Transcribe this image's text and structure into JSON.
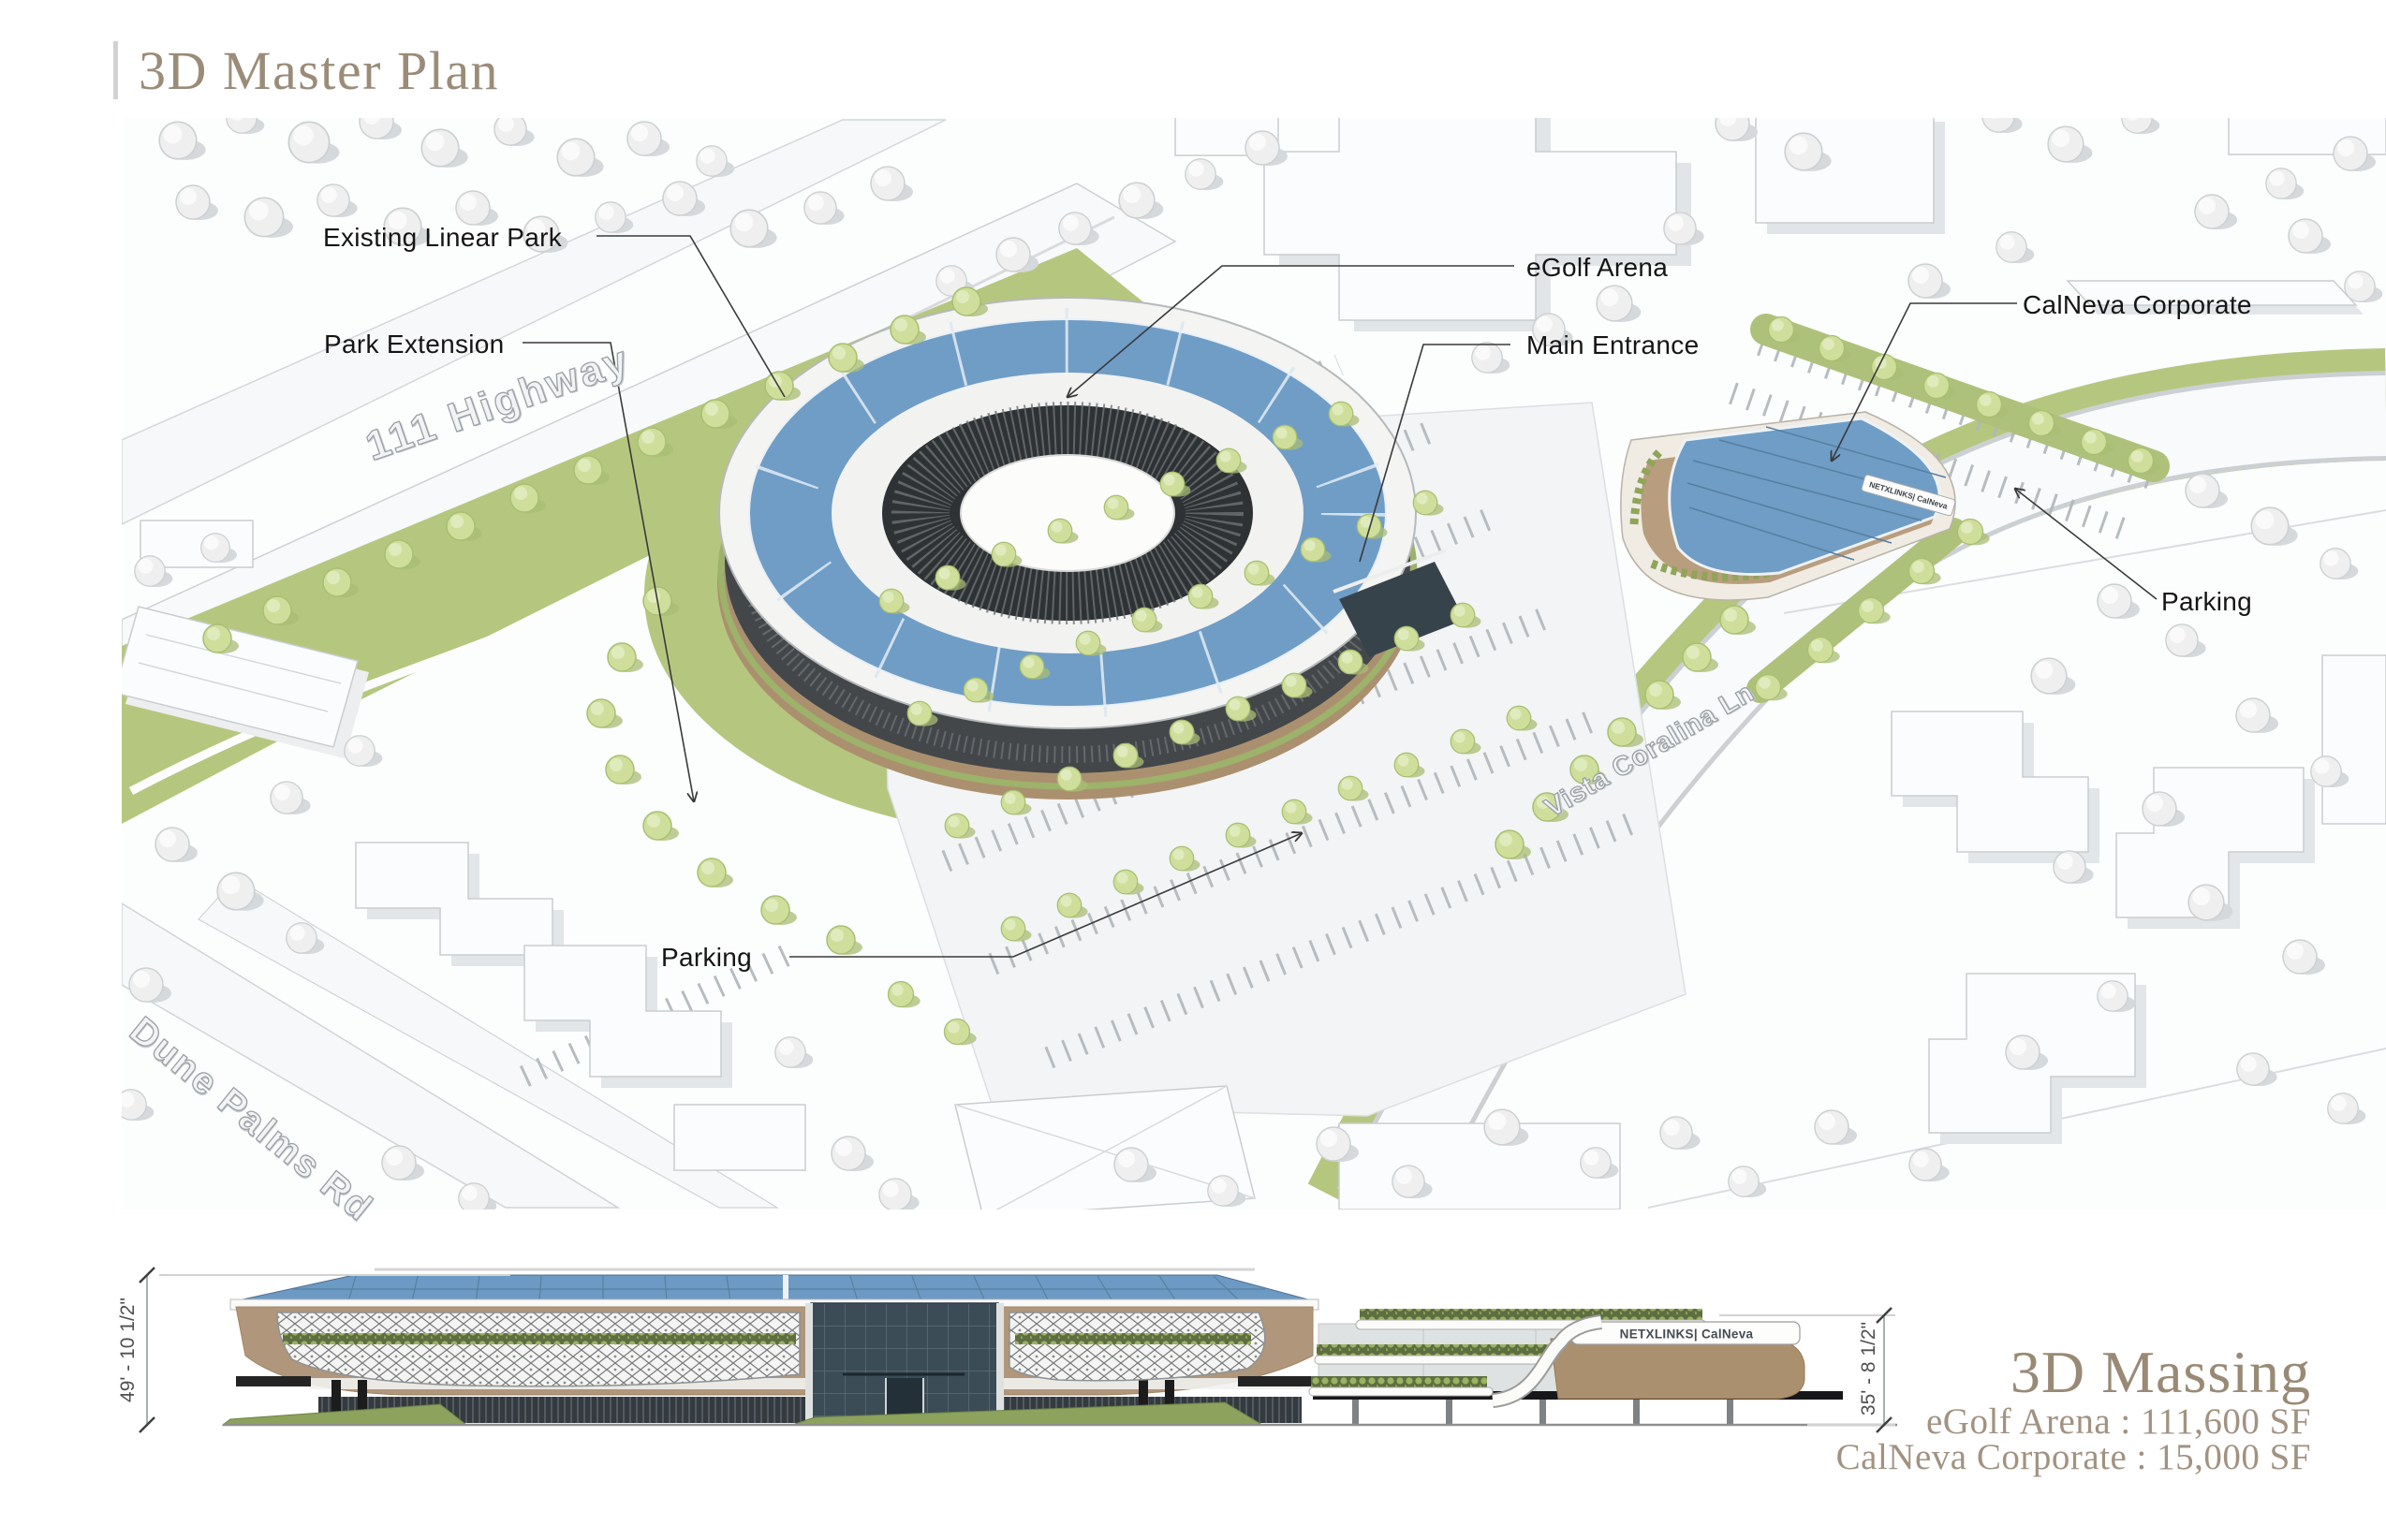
{
  "title": "3D Master Plan",
  "labels": {
    "existing_linear_park": "Existing Linear Park",
    "park_extension": "Park Extension",
    "egolf_arena": "eGolf Arena",
    "main_entrance": "Main Entrance",
    "calneva_corporate": "CalNeva Corporate",
    "parking_right": "Parking",
    "parking_left": "Parking"
  },
  "streets": {
    "highway": "111 Highway",
    "vista_coralina": "Vista Coralina Ln",
    "dune_palms": "Dune Palms Rd"
  },
  "massing": {
    "title": "3D Massing",
    "egolf_area": "eGolf Arena : 111,600 SF",
    "calneva_area": "CalNeva Corporate : 15,000 SF"
  },
  "dimensions": {
    "arena_height": "49' - 10 1/2\"",
    "calneva_height": "35' - 8 1/2\""
  },
  "signage": {
    "netxlinks": "NETXLINKS| CalNeva"
  },
  "colors": {
    "accent_blue": "#6f9dc6",
    "landscape_green": "#b5c77f",
    "title_taupe": "#9b8c79",
    "facade_tan": "#ac9272",
    "mesh_dark": "#3f4446"
  }
}
